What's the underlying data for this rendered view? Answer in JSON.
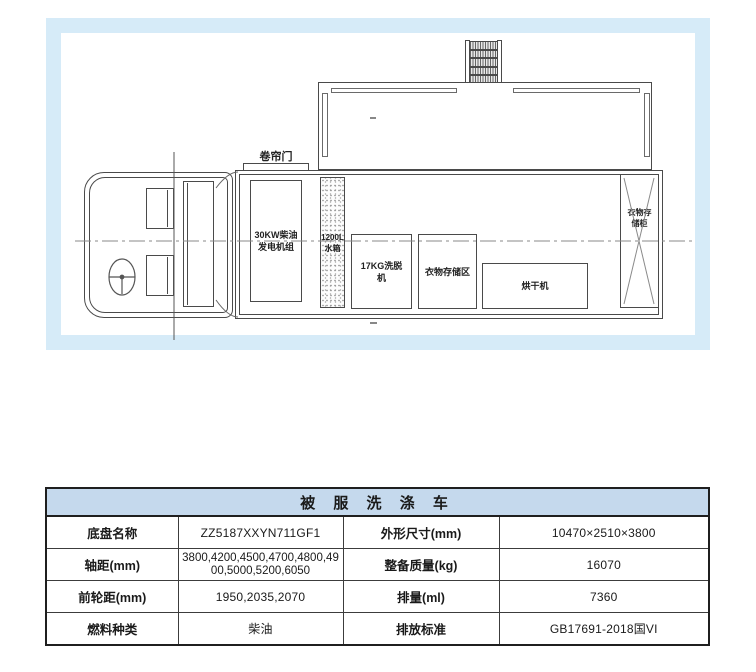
{
  "diagram": {
    "frame_color": "#d6ebf8",
    "line_color": "#4a4a4a",
    "roll_door_label": "卷帘门",
    "generator_label_line1": "30KW柴油",
    "generator_label_line2": "发电机组",
    "water_tank_label_line1": "1200L",
    "water_tank_label_line2": "水箱",
    "washer_label_line1": "17KG洗脱",
    "washer_label_line2": "机",
    "storage_area_label": "衣物存储区",
    "dryer_label": "烘干机",
    "cabinet_label_line1": "衣物存",
    "cabinet_label_line2": "储柜"
  },
  "table": {
    "title": "被 服 洗 涤 车",
    "header_bg": "#c5d9ed",
    "rows": [
      {
        "label1": "底盘名称",
        "value1": "ZZ5187XXYN711GF1",
        "label2": "外形尺寸(mm)",
        "value2": "10470×2510×3800"
      },
      {
        "label1": "轴距(mm)",
        "value1": "3800,4200,4500,4700,4800,4900,5000,5200,6050",
        "label2": "整备质量(kg)",
        "value2": "16070"
      },
      {
        "label1": "前轮距(mm)",
        "value1": "1950,2035,2070",
        "label2": "排量(ml)",
        "value2": "7360"
      },
      {
        "label1": "燃料种类",
        "value1": "柴油",
        "label2": "排放标准",
        "value2": "GB17691-2018国VI"
      }
    ]
  }
}
